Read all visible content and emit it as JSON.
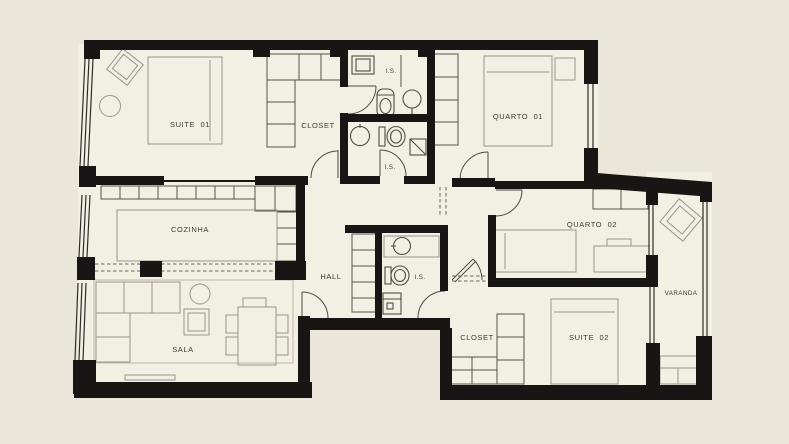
{
  "plan": {
    "title": "apartment-floor-plan",
    "colors": {
      "background": "#eae7da",
      "floor": "#f2efe3",
      "walls": "#171614",
      "furniture_lines": "#9a968b",
      "cabinetry_lines": "#57544b",
      "text": "#3f3d37"
    },
    "rooms": {
      "suite01": {
        "label": "SUITE  01"
      },
      "closet1": {
        "label": "CLOSET"
      },
      "bath1": {
        "label": "I.S."
      },
      "bath2": {
        "label": "I.S."
      },
      "quarto01": {
        "label": "QUARTO  01"
      },
      "cozinha": {
        "label": "COZINHA"
      },
      "hall": {
        "label": "HALL"
      },
      "bath3": {
        "label": "I.S."
      },
      "quarto02": {
        "label": "QUARTO  02"
      },
      "varanda": {
        "label": "VARANDA"
      },
      "closet2": {
        "label": "CLOSET"
      },
      "suite02": {
        "label": "SUITE  02"
      },
      "sala": {
        "label": "SALA"
      }
    }
  }
}
